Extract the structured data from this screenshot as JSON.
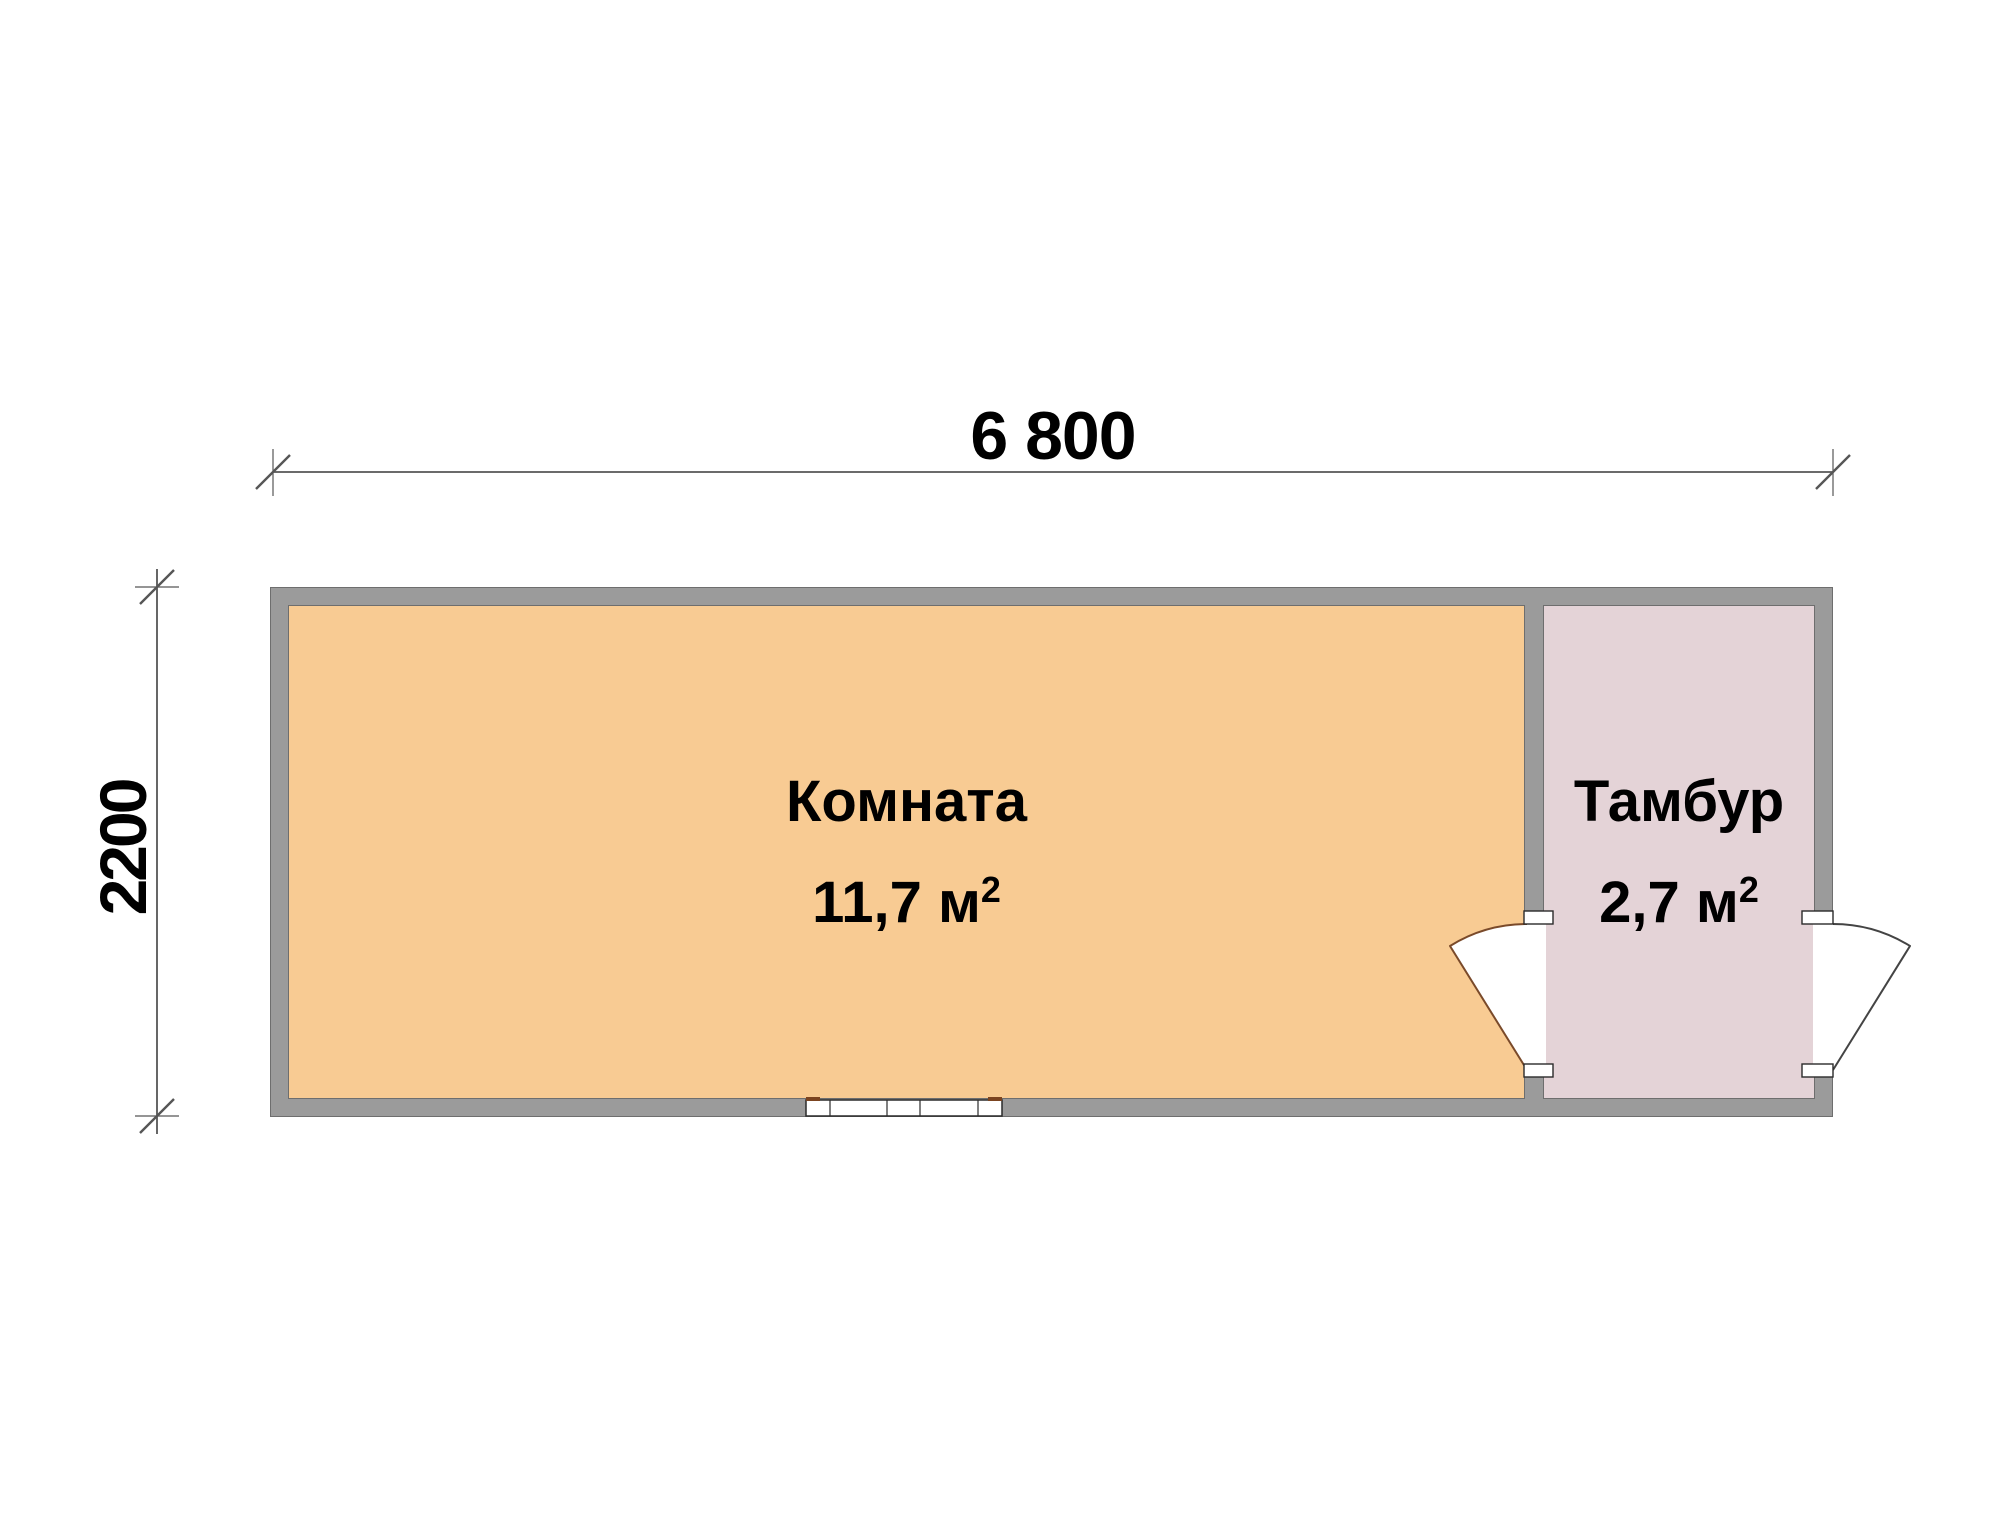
{
  "plan": {
    "dimensions": {
      "width_label": "6 800",
      "height_label": "2200"
    },
    "rooms": [
      {
        "name": "Комната",
        "area_value": "11,7 м",
        "area_sup": "2"
      },
      {
        "name": "Тамбур",
        "area_value": "2,7 м",
        "area_sup": "2"
      }
    ]
  },
  "colors": {
    "room1_fill": "#F8CB93",
    "room2_fill": "#E4D3D7",
    "wall": "#9B9B9B",
    "wall_edge": "#6E6E6E",
    "dim_line": "#565656",
    "door_interior_stroke": "#7A4A2A",
    "door_exterior_stroke": "#444444",
    "window_stroke": "#2B2B2B",
    "window_accent": "#7B4420",
    "text": "#000000"
  }
}
